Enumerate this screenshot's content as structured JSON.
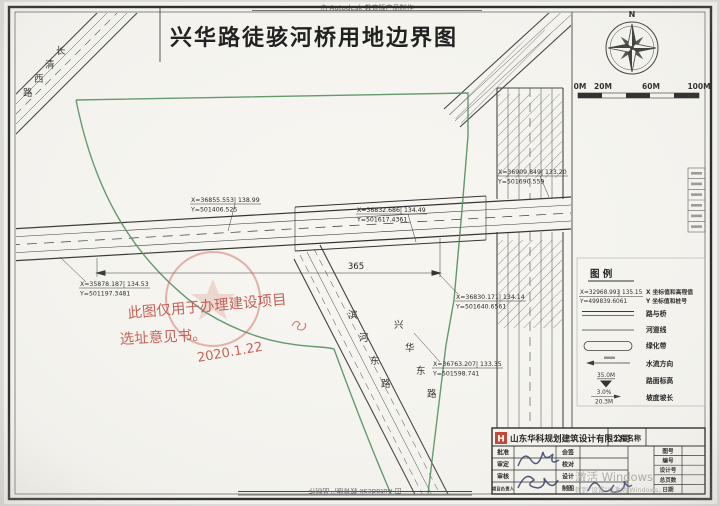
{
  "banner": {
    "top": "由 Autodesk 教育版产品制作",
    "bottom": "由 Autodesk 教育版产品制作"
  },
  "title": "兴华路徒骇河桥用地边界图",
  "compass": {
    "north": "N"
  },
  "scalebar": {
    "labels": [
      "0M",
      "20M",
      "60M",
      "100M"
    ]
  },
  "road_labels": {
    "changqing": "长清西路",
    "binhe": "滨河东路",
    "xinghua_east": "兴华东路"
  },
  "dimensions": {
    "bridge_span": "365"
  },
  "callouts": [
    {
      "x": "X=36855.553",
      "elev": "138.99",
      "y": "Y=501406.525"
    },
    {
      "x": "X=36832.686",
      "elev": "134.49",
      "y": "Y=501617.4361"
    },
    {
      "x": "X=36909.849",
      "elev": "133.20",
      "y": "Y=501690.559"
    },
    {
      "x": "X=35878.187",
      "elev": "134.53",
      "y": "Y=501197.3481"
    },
    {
      "x": "X=36830.171",
      "elev": "134.14",
      "y": "Y=501640.6561"
    },
    {
      "x": "X=36763.207",
      "elev": "133.35",
      "y": "Y=501598.741"
    }
  ],
  "stamp": {
    "line1": "此图仅用于办理建设项目",
    "line2": "选址意见书。",
    "date": "2020.1.22"
  },
  "legend": {
    "title": "图  例",
    "sample": {
      "x": "X=32968.993",
      "elev": "135.15",
      "y": "Y=499839.6061"
    },
    "sample_label1": "X 坐标值和高程值",
    "sample_label2": "Y 坐标值和桩号",
    "items": [
      {
        "label": "路与桥"
      },
      {
        "label": "河道线"
      },
      {
        "label": "绿化带"
      },
      {
        "label": "水流方向"
      },
      {
        "label": "路面标高",
        "value": "35.0M"
      },
      {
        "label": "坡度坡长",
        "value1": "3.0%",
        "value2": "20.3M"
      }
    ]
  },
  "titleblock": {
    "logo": "H",
    "company": "山东华科规划建筑设计有限公司",
    "project_label": "工程名称",
    "rows": [
      [
        "批准",
        "会签"
      ],
      [
        "审定",
        "校对"
      ],
      [
        "审核",
        "设计"
      ],
      [
        "项目负责人",
        "制图"
      ]
    ],
    "right_rows": [
      "图号",
      "编号",
      "设计号",
      "总页数",
      "日期"
    ]
  },
  "watermark": {
    "line1": "激活 Windows",
    "line2": "转到“设置”以激活 Windows。"
  }
}
